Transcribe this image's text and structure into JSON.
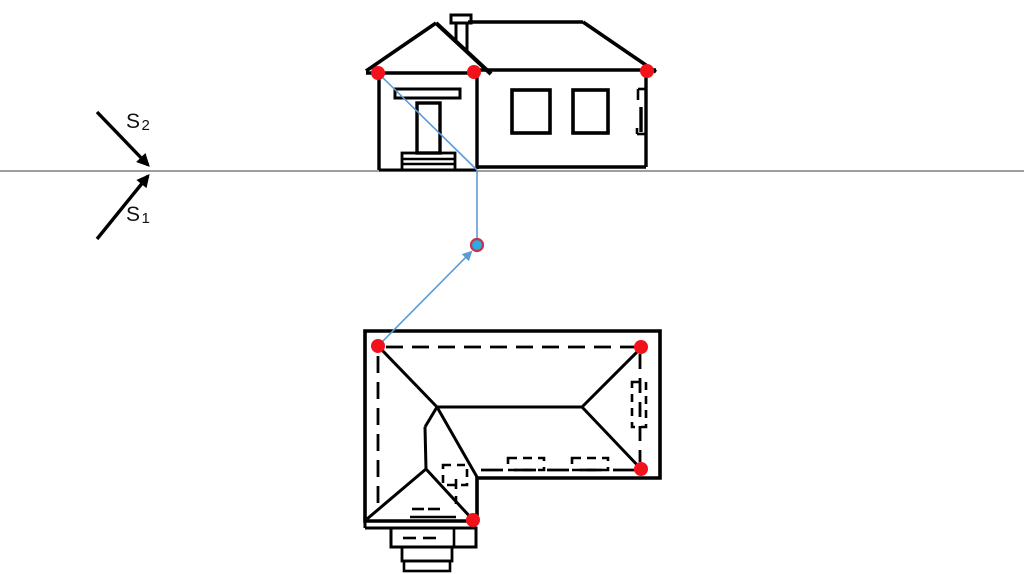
{
  "canvas": {
    "width": 1024,
    "height": 574,
    "background": "#ffffff"
  },
  "colors": {
    "ink": "#000000",
    "horizon": "#7f7f7f",
    "red_dot": "#f2121b",
    "blue_dot_fill": "#2aabe2",
    "blue_dot_stroke": "#c9324a",
    "blue_line": "#5b9bd5"
  },
  "horizon": {
    "n": "horizon-line",
    "p": [
      0,
      171,
      1024,
      171
    ],
    "w": 1.4
  },
  "station": {
    "arrows": [
      {
        "n": "sight-arrow-s2",
        "p": [
          97,
          112,
          148,
          165
        ],
        "w": 3.4
      },
      {
        "n": "sight-arrow-s1",
        "p": [
          97,
          239,
          148,
          176
        ],
        "w": 3.4
      }
    ],
    "labels": [
      {
        "main": "S",
        "sub": "2",
        "x": 126,
        "y": 111
      },
      {
        "main": "S",
        "sub": "1",
        "x": 126,
        "y": 204
      }
    ]
  },
  "elevation": {
    "stroke_w": 3.2,
    "lines": [
      {
        "n": "porch-roof-left-slope",
        "p": [
          366,
          71,
          436,
          23
        ],
        "w": 3.6
      },
      {
        "n": "porch-roof-right-slope",
        "p": [
          436,
          23,
          491,
          74
        ],
        "w": 4.2
      },
      {
        "n": "porch-eave",
        "p": [
          366,
          73,
          477,
          73
        ],
        "w": 3.6
      },
      {
        "n": "chimney-left-edge",
        "p": [
          456,
          23,
          456,
          40
        ],
        "w": 3
      },
      {
        "n": "chimney-right-edge",
        "p": [
          467,
          23,
          467,
          51
        ],
        "w": 3
      },
      {
        "n": "main-roof-ridge",
        "p": [
          468,
          22,
          583,
          22
        ],
        "w": 3.6
      },
      {
        "n": "main-roof-right-slope",
        "p": [
          583,
          22,
          656,
          72
        ],
        "w": 3.6
      },
      {
        "n": "main-eave",
        "p": [
          474,
          70,
          656,
          70
        ],
        "w": 3.4
      },
      {
        "n": "left-wall-edge",
        "p": [
          379,
          74,
          379,
          170
        ],
        "w": 3.4
      },
      {
        "n": "porch-main-wall-divider",
        "p": [
          477,
          73,
          477,
          169
        ],
        "w": 3.4
      },
      {
        "n": "right-wall-edge",
        "p": [
          646,
          73,
          646,
          167
        ],
        "w": 3.4
      },
      {
        "n": "porch-base-line",
        "p": [
          379,
          170,
          477,
          170
        ],
        "w": 3
      },
      {
        "n": "main-base-line",
        "p": [
          477,
          167,
          646,
          167
        ],
        "w": 3.4
      },
      {
        "n": "step-tread-line-1",
        "p": [
          402,
          159,
          455,
          159
        ],
        "w": 2.4
      },
      {
        "n": "step-tread-line-2",
        "p": [
          402,
          164,
          455,
          164
        ],
        "w": 2.4
      },
      {
        "n": "side-door-jamb-top-h",
        "p": [
          646,
          89,
          638,
          89
        ],
        "w": 2.6
      },
      {
        "n": "side-door-jamb-top-v",
        "p": [
          638,
          89,
          638,
          100
        ],
        "w": 2.6
      },
      {
        "n": "side-door-handle",
        "p": [
          641,
          107,
          641,
          132
        ],
        "w": 3.4
      },
      {
        "n": "side-door-jamb-bottom-v",
        "p": [
          637,
          128,
          637,
          134
        ],
        "w": 2.6
      },
      {
        "n": "side-door-jamb-bottom-h",
        "p": [
          637,
          134,
          646,
          134
        ],
        "w": 2.6
      }
    ],
    "rects": [
      {
        "n": "chimney-cap",
        "r": [
          451,
          15,
          20,
          8
        ],
        "w": 3
      },
      {
        "n": "transom-window",
        "r": [
          395,
          89,
          65,
          9
        ],
        "w": 3
      },
      {
        "n": "entry-door",
        "r": [
          417,
          103,
          23,
          50
        ],
        "w": 3.4
      },
      {
        "n": "entry-steps",
        "r": [
          402,
          153,
          53,
          17
        ],
        "w": 2.8
      },
      {
        "n": "window-left",
        "r": [
          512,
          90,
          38,
          43
        ],
        "w": 3.6
      },
      {
        "n": "window-right",
        "r": [
          573,
          90,
          35,
          43
        ],
        "w": 3.6
      }
    ]
  },
  "plan": {
    "outline": {
      "n": "roof-eave-outline",
      "points": "365,331 660,331 660,478 477,478 477,521 365,521",
      "w": 3.6
    },
    "lines": [
      {
        "n": "hip-top-left",
        "p": [
          379,
          347,
          437,
          407
        ],
        "w": 3
      },
      {
        "n": "roof-ridge",
        "p": [
          437,
          407,
          582,
          407
        ],
        "w": 3
      },
      {
        "n": "hip-top-right",
        "p": [
          641,
          348,
          582,
          407
        ],
        "w": 3
      },
      {
        "n": "hip-bottom-right",
        "p": [
          641,
          469,
          582,
          407
        ],
        "w": 3
      },
      {
        "n": "valley-right",
        "p": [
          437,
          407,
          477,
          477
        ],
        "w": 3
      },
      {
        "n": "valley-left",
        "p": [
          437,
          407,
          425,
          427
        ],
        "w": 3
      },
      {
        "n": "porch-ridge",
        "p": [
          425,
          427,
          426,
          469
        ],
        "w": 3
      },
      {
        "n": "porch-hip-left",
        "p": [
          426,
          469,
          367,
          519
        ],
        "w": 3
      },
      {
        "n": "porch-hip-right",
        "p": [
          426,
          469,
          473,
          520
        ],
        "w": 3
      },
      {
        "n": "eave-corner-drop",
        "p": [
          365,
          521,
          365,
          528
        ],
        "w": 3
      },
      {
        "n": "eave-foot-segment",
        "p": [
          365,
          528,
          391,
          528
        ],
        "w": 3
      },
      {
        "n": "stoop-threshold-line",
        "p": [
          410,
          517,
          456,
          517
        ],
        "w": 2.6
      },
      {
        "n": "plan-step-divider",
        "p": [
          454,
          528,
          454,
          547
        ],
        "w": 2.6
      }
    ],
    "rects": [
      {
        "n": "plan-step-1",
        "r": [
          391,
          528,
          85,
          19
        ],
        "w": 3
      },
      {
        "n": "plan-step-2",
        "r": [
          402,
          547,
          50,
          14
        ],
        "w": 2.8
      },
      {
        "n": "plan-step-3",
        "r": [
          404,
          561,
          46,
          10
        ],
        "w": 2.6
      }
    ],
    "dashed_lines": [
      {
        "n": "wall-line-top",
        "p": [
          386,
          347,
          636,
          347
        ],
        "w": 2.8,
        "dash": "17,9"
      },
      {
        "n": "wall-line-left",
        "p": [
          378,
          356,
          378,
          503
        ],
        "w": 2.8,
        "dash": "17,9"
      },
      {
        "n": "wall-line-right",
        "p": [
          640,
          354,
          640,
          462
        ],
        "w": 2.8,
        "dash": "15,9"
      },
      {
        "n": "wall-line-bottom-main",
        "p": [
          481,
          470,
          636,
          470
        ],
        "w": 2.8,
        "dash": "22,11"
      },
      {
        "n": "wall-line-porch-right",
        "p": [
          456,
          479,
          456,
          504
        ],
        "w": 2.6,
        "dash": "10,7"
      },
      {
        "n": "step-dash-1",
        "p": [
          403,
          538,
          416,
          538
        ],
        "w": 2.6,
        "dash": "13,8"
      },
      {
        "n": "step-dash-2",
        "p": [
          423,
          538,
          436,
          538
        ],
        "w": 2.6,
        "dash": "13,8"
      },
      {
        "n": "stoop-dash-1",
        "p": [
          412,
          509,
          424,
          509
        ],
        "w": 2.6,
        "dash": "12,6"
      },
      {
        "n": "stoop-dash-2",
        "p": [
          428,
          509,
          440,
          509
        ],
        "w": 2.6,
        "dash": "12,6"
      }
    ],
    "dashed_rects": [
      {
        "n": "chimney-plan-mark",
        "r": [
          443,
          465,
          24,
          20
        ],
        "w": 2.6,
        "dash": "8,6"
      },
      {
        "n": "window-plan-right-mark",
        "r": [
          632,
          382,
          14,
          45
        ],
        "w": 2.6,
        "dash": "8,6"
      },
      {
        "n": "window-plan-bottom-mark-1",
        "r": [
          508,
          458,
          36,
          12
        ],
        "w": 2.6,
        "dash": "9,6"
      },
      {
        "n": "window-plan-bottom-mark-2",
        "r": [
          572,
          458,
          36,
          12
        ],
        "w": 2.6,
        "dash": "9,6"
      }
    ]
  },
  "construction": {
    "blue_lines": [
      {
        "n": "sightline-elevation-diagonal",
        "p": [
          378,
          73,
          477,
          170
        ],
        "w": 1.6
      },
      {
        "n": "sightline-vertical",
        "p": [
          477,
          170,
          477,
          238
        ],
        "w": 1.6
      }
    ],
    "blue_arrow": {
      "n": "sightline-plan-arrow",
      "p": [
        378,
        346,
        471,
        252
      ],
      "w": 1.6
    },
    "blue_dot": {
      "n": "station-point",
      "cx": 477,
      "cy": 245,
      "r": 6
    },
    "red_dot_r": 7,
    "red_dots": [
      {
        "n": "corner-point-elevation-left",
        "c": [
          378,
          73
        ]
      },
      {
        "n": "corner-point-elevation-middle",
        "c": [
          474,
          72
        ]
      },
      {
        "n": "corner-point-elevation-right",
        "c": [
          647,
          71
        ]
      },
      {
        "n": "corner-point-plan-top-left",
        "c": [
          378,
          346
        ]
      },
      {
        "n": "corner-point-plan-top-right",
        "c": [
          641,
          347
        ]
      },
      {
        "n": "corner-point-plan-bottom-right",
        "c": [
          641,
          469
        ]
      },
      {
        "n": "corner-point-plan-porch",
        "c": [
          473,
          520
        ]
      }
    ]
  }
}
